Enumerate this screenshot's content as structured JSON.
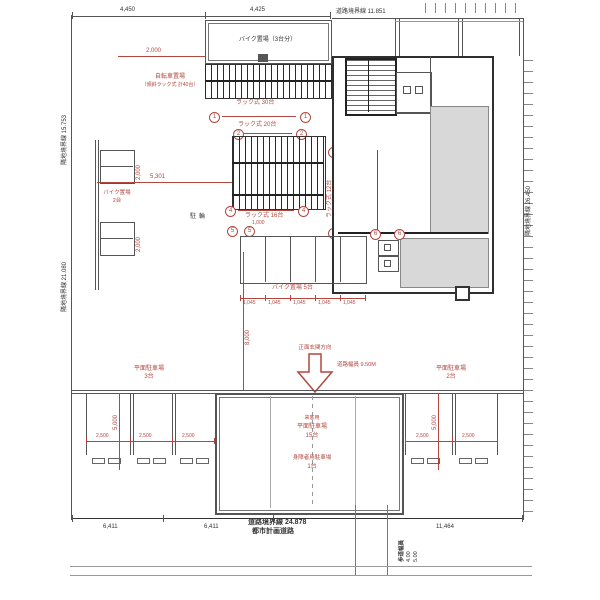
{
  "colors": {
    "annotation": "#b2473f",
    "line": "#444444",
    "room_fill": "#d8d8d8"
  },
  "boundaries": {
    "left_top": "隣地境界線 15.753",
    "left_bottom": "隣地境界線 21.080",
    "right": "隣地境界線 26.450",
    "top": "道路境界線 11.851",
    "bottom_1": "道路境界線 24.878",
    "bottom_2": "都市計画道路"
  },
  "areas": {
    "shelter": "バイク置場（3台分）",
    "bicycle_1": "自転車置場",
    "bicycle_2": "（傾斜ラック式 計40台）",
    "rack_30": "ラック式 30台",
    "rack_20": "ラック式 20台",
    "rack_16": "ラック式 16台",
    "rack_12": "ラック式 12台",
    "yard": "駐輪",
    "moto_2_line1": "バイク置場",
    "moto_2_line2": "2台",
    "moto_5": "バイク置場 5台",
    "entrance": "正面玄関方向",
    "road_width": "道路幅員 9.50M",
    "lot_left_1": "平面駐車場",
    "lot_left_2": "3台",
    "lot_right_1": "平面駐車場",
    "lot_right_2": "2台",
    "lot_center_1": "来客用",
    "lot_center_2": "平面駐車場",
    "lot_center_3": "15台",
    "lot_center_4": "身障者用駐車場",
    "lot_center_5": "1台",
    "sidewalk": "歩道幅員",
    "sidewalk_w1": "4.00",
    "sidewalk_w2": "5.00"
  },
  "dims": {
    "top_left": "4,450",
    "top_right": "4,425",
    "shelter": "2,000",
    "rack_w": "5,301",
    "moto_1": "2,000",
    "moto_2": "2,000",
    "pitch": "1,000",
    "approach": "8,000",
    "stall_chain": [
      "1,045",
      "1,045",
      "1,045",
      "1,045",
      "1,045"
    ],
    "left": [
      "2,500",
      "2,500",
      "2,500"
    ],
    "right": [
      "2,500",
      "2,500"
    ],
    "left_d": "5,000",
    "right_d": "5,000",
    "bottom": [
      "6,411",
      "6,411",
      "11,464"
    ]
  },
  "markers": {
    "m1": "1",
    "m2": "2",
    "m3": "3",
    "m4": "4",
    "m5": "5",
    "m6": "6"
  }
}
